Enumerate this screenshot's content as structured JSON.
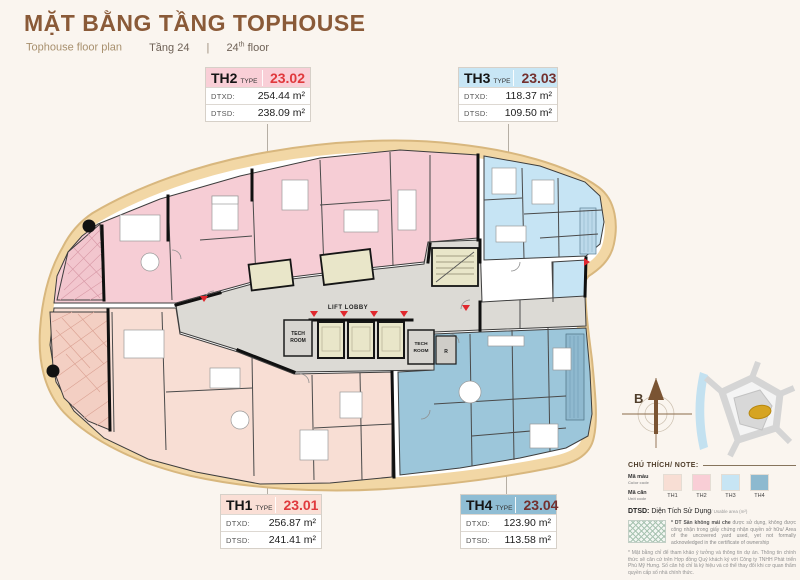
{
  "header": {
    "title": "MẶT BẰNG TẦNG TOPHOUSE",
    "subtitle": "Tophouse floor plan",
    "floor_vi": "Tầng 24",
    "divider": "|",
    "floor_num": "24",
    "floor_sup": "th",
    "floor_word": "floor"
  },
  "units": [
    {
      "id": "TH2",
      "type_label": "TYPE",
      "code": "23.02",
      "dtxd_label": "DTXD:",
      "dtxd_value": "254.44 m²",
      "dtsd_label": "DTSD:",
      "dtsd_value": "238.09 m²",
      "header_bg": "#f9cfd7",
      "code_color": "#e0393d"
    },
    {
      "id": "TH3",
      "type_label": "TYPE",
      "code": "23.03",
      "dtxd_label": "DTXD:",
      "dtxd_value": "118.37 m²",
      "dtsd_label": "DTSD:",
      "dtsd_value": "109.50 m²",
      "header_bg": "#c8e6f5",
      "code_color": "#74302e"
    },
    {
      "id": "TH1",
      "type_label": "TYPE",
      "code": "23.01",
      "dtxd_label": "DTXD:",
      "dtxd_value": "256.87 m²",
      "dtsd_label": "DTSD:",
      "dtsd_value": "241.41 m²",
      "header_bg": "#fadfd6",
      "code_color": "#e0393d"
    },
    {
      "id": "TH4",
      "type_label": "TYPE",
      "code": "23.04",
      "dtxd_label": "DTXD:",
      "dtxd_value": "123.90 m²",
      "dtsd_label": "DTSD:",
      "dtsd_value": "113.58 m²",
      "header_bg": "#8fbdd4",
      "code_color": "#74302e"
    }
  ],
  "plan": {
    "lift_lobby": "LIFT LOBBY",
    "tech_room_left_1": "TECH",
    "tech_room_left_2": "ROOM",
    "tech_room_mid_1": "TECH",
    "tech_room_mid_2": "ROOM",
    "room_r": "R",
    "colors": {
      "th1": "#f8ded4",
      "th2": "#f6cdd5",
      "th3": "#c6e4f4",
      "th4": "#9cc6da",
      "lobby": "#dcdad5",
      "band": "#f2d7a5",
      "core": "#e9e6c9",
      "accent_red": "#e0282e"
    }
  },
  "compass": {
    "north_label": "B"
  },
  "legend": {
    "heading": "CHÚ THÍCH/ NOTE:",
    "color_code_vi": "Mã màu",
    "color_code_en": "Color code",
    "unit_code_vi": "Mã căn",
    "unit_code_en": "Unit code",
    "swatches": [
      {
        "label": "TH1",
        "color": "#f8ded4"
      },
      {
        "label": "TH2",
        "color": "#f9ced6"
      },
      {
        "label": "TH3",
        "color": "#c7e5f4"
      },
      {
        "label": "TH4",
        "color": "#8db9cf"
      }
    ],
    "dtsd_label": "DTSD:",
    "dtsd_vi": " Diện Tích Sử Dụng",
    "dtsd_en": "/ Usable area (m²)",
    "note1_bold": "* DT Sân không mái che ",
    "note1_text": "được sử dụng, không được công nhận trong giấy chứng nhận quyền sở hữu/ Area of the uncovered yard used, yet not formally acknowledged in the certificate of ownership",
    "note2": "* Mặt bằng chỉ để tham khảo ý tưởng và thông tin dự án. Thông tin chính thức sẽ căn cứ trên Hợp đồng Quý khách ký với Công ty TNHH Phát triển Phú Mỹ Hưng. Số căn hộ chỉ là ký hiệu và có thể thay đổi khi cơ quan thẩm quyền cấp số nhà chính thức.",
    "note3": "The layout is for reference purposes only. The official information must be based on the Contract signed with Phu My Hung Development Corporation. The condo number is just temporary symbol and will be changed by appropriate authorities when issuing the official one."
  }
}
